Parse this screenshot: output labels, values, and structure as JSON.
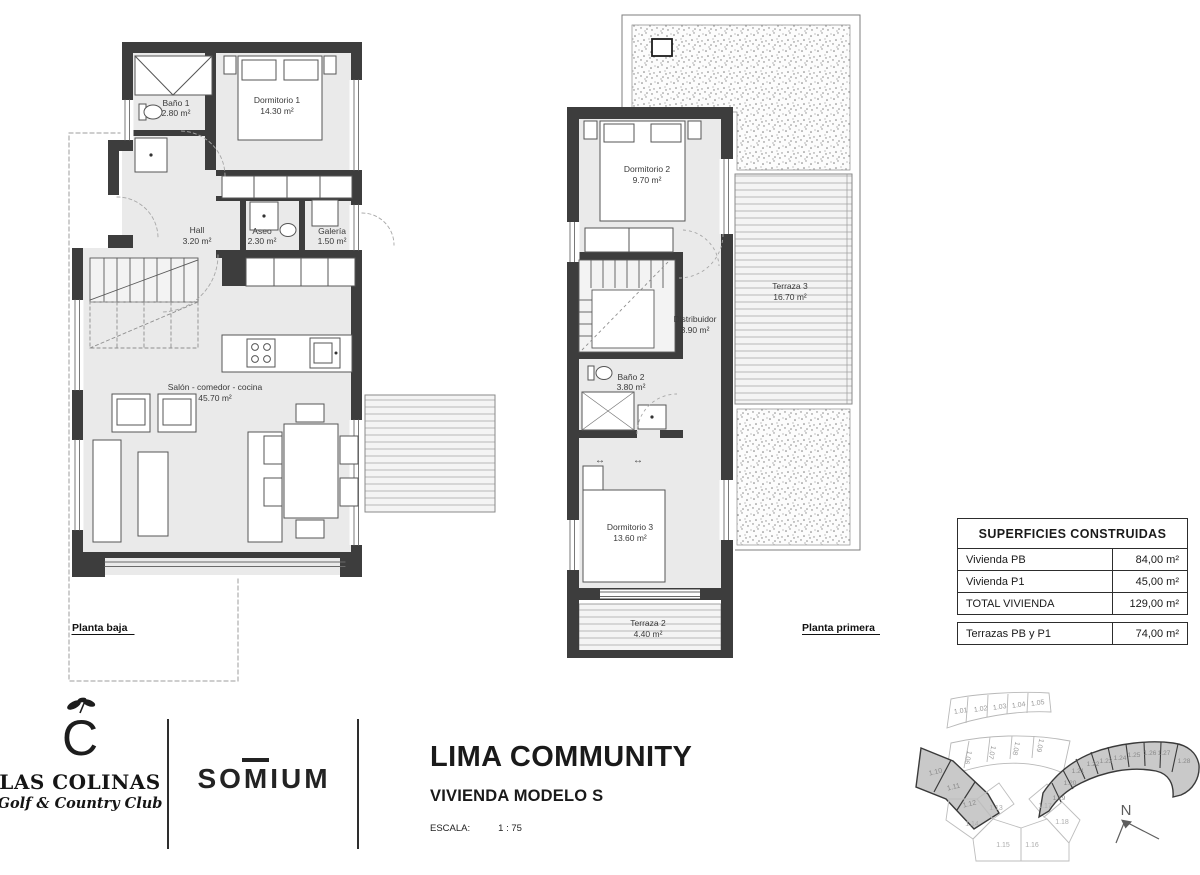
{
  "title_block": {
    "title": "LIMA COMMUNITY",
    "subtitle": "VIVIENDA MODELO S",
    "scale_label": "ESCALA:",
    "scale_value": "1 : 75"
  },
  "branding": {
    "las_colinas_monogram": "C",
    "las_colinas_name": "LAS COLINAS",
    "las_colinas_tagline": "Golf & Country Club",
    "somium": "SOMIUM"
  },
  "ground_floor": {
    "plan_label": "Planta baja",
    "rooms": [
      {
        "name": "Baño 1",
        "area": "2.80 m²"
      },
      {
        "name": "Dormitorio 1",
        "area": "14.30 m²"
      },
      {
        "name": "Hall",
        "area": "3.20 m²"
      },
      {
        "name": "Aseo",
        "area": "2.30 m²"
      },
      {
        "name": "Galería",
        "area": "1.50 m²"
      },
      {
        "name": "Salón - comedor - cocina",
        "area": "45.70 m²"
      }
    ]
  },
  "first_floor": {
    "plan_label": "Planta primera",
    "rooms": [
      {
        "name": "Dormitorio 2",
        "area": "9.70 m²"
      },
      {
        "name": "Terraza 3",
        "area": "16.70 m²"
      },
      {
        "name": "Distribuidor",
        "area": "3.90 m²"
      },
      {
        "name": "Baño 2",
        "area": "3.80 m²"
      },
      {
        "name": "Dormitorio 3",
        "area": "13.60 m²"
      },
      {
        "name": "Terraza 2",
        "area": "4.40 m²"
      }
    ]
  },
  "areas_table": {
    "header": "SUPERFICIES CONSTRUIDAS",
    "rows": [
      {
        "label": "Vivienda PB",
        "value": "84,00 m²"
      },
      {
        "label": "Vivienda P1",
        "value": "45,00 m²"
      },
      {
        "label": "TOTAL VIVIENDA",
        "value": "129,00 m²"
      }
    ],
    "terrace_row": {
      "label": "Terrazas PB y P1",
      "value": "74,00 m²"
    }
  },
  "site_plan": {
    "north_label": "N",
    "rows": {
      "top": [
        "1.01",
        "1.02",
        "1.03",
        "1.04",
        "1.05"
      ],
      "second": [
        "1.06",
        "1.07",
        "1.08",
        "1.09"
      ],
      "left_shaded": [
        "1.10",
        "1.11",
        "1.12"
      ],
      "center": [
        "1.13",
        "1.14",
        "1.15",
        "1.16",
        "1.17",
        "1.18"
      ],
      "right_shaded": [
        "1.19",
        "1.20",
        "1.21",
        "1.22",
        "1.23",
        "1.24",
        "1.25",
        "1.26",
        "1.27",
        "1.28"
      ]
    }
  },
  "colors": {
    "wall": "#3d3d3d",
    "floor": "#eaeaea",
    "shaded_lot": "#c9c9c9"
  }
}
